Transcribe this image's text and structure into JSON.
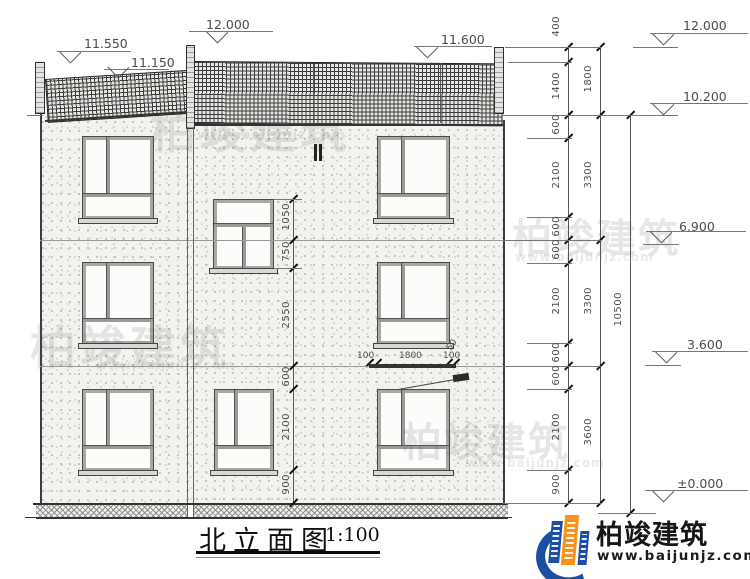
{
  "title": {
    "text": "北立面图",
    "scale": "1:100"
  },
  "markers": {
    "left": [
      "11.550",
      "11.150",
      "12.000",
      "11.600"
    ],
    "right": [
      "12.000",
      "10.200",
      "6.900",
      "3.600",
      "±0.000"
    ]
  },
  "dims": {
    "detail": [
      "400",
      "1400",
      "600",
      "2100",
      "600",
      "600",
      "2100",
      "600",
      "600",
      "2100",
      "900"
    ],
    "floors": [
      "1800",
      "3300",
      "3300",
      "3600"
    ],
    "overall": "10500",
    "mid": [
      "1050",
      "750",
      "2550",
      "600",
      "2100",
      "900"
    ],
    "canopy": [
      "100",
      "1800",
      "100",
      "50"
    ]
  },
  "brand": {
    "name": "柏竣建筑",
    "url": "www.baijunjz.com"
  },
  "watermark": {
    "name": "柏竣建筑",
    "url": "www.baijunjz.com"
  },
  "colors": {
    "brand_blue": "#1c4fa1",
    "brand_orange": "#f7941d",
    "line": "#555555"
  }
}
